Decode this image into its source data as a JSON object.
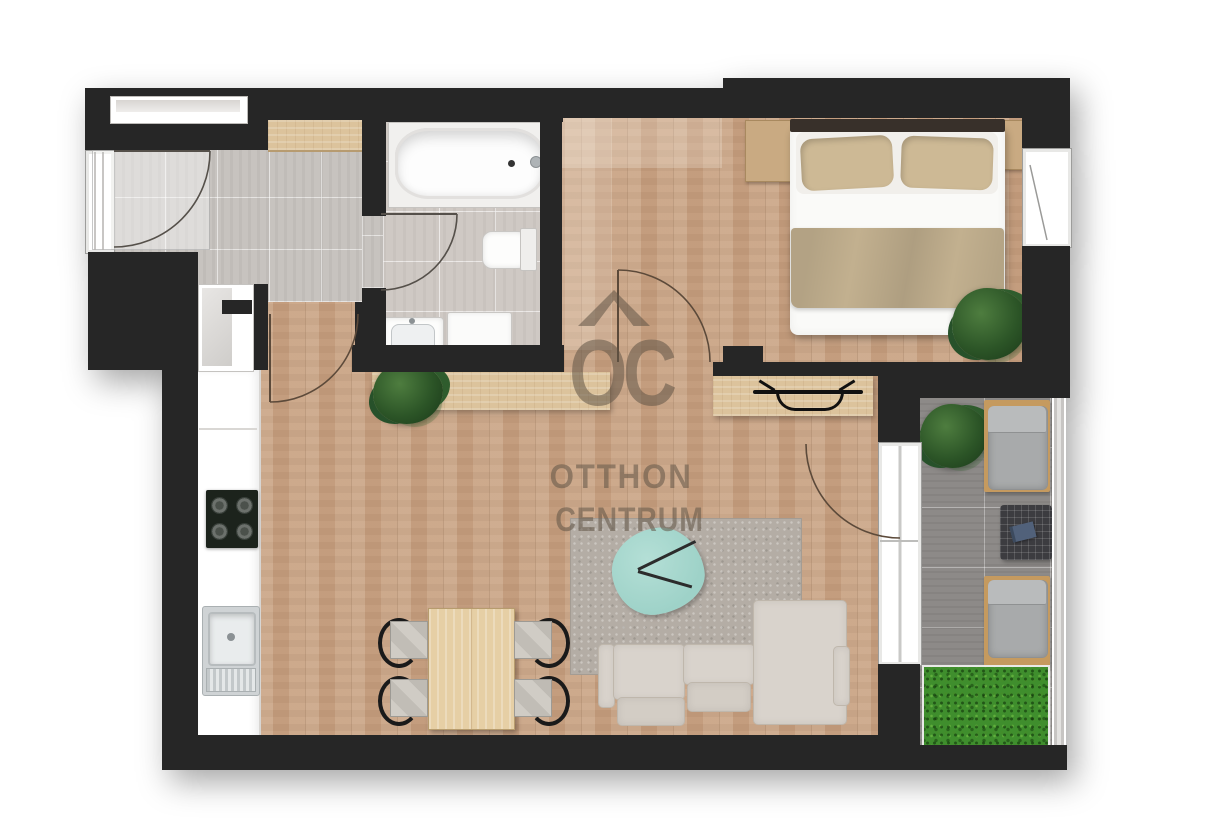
{
  "brand": {
    "logo_text": "OC",
    "chevron_icon": "roof-chevron",
    "line1": "OTTHON",
    "line2": "CENTRUM"
  },
  "palette": {
    "wall": "#262626",
    "wood": "#c8a283",
    "tile_hall": "#c7c3bf",
    "tile_bath": "#cfc9c4",
    "tile_balcony": "#8d8a88",
    "grass": "#3f8e2d",
    "rug": "#b4ada5",
    "coffee_table": "#9ed2c8",
    "sofa": "#d9d3cc",
    "bed_linen": "#fafaf8",
    "bed_blanket": "#c2b08f",
    "pillow": "#cdb995",
    "headboard": "#38302a",
    "counter": "#ffffff",
    "cooktop": "#1c231c",
    "plant": "#2c5527",
    "dining_wood": "#e6cfa5",
    "nightstand": "#c9aa82",
    "console_wood": "#dcc39c",
    "lounger_cushion": "#a8aaab",
    "lounger_wood": "#c59a5f",
    "outdoor_table": "#3c3c40",
    "railing": "#c7c5c3",
    "door_line": "#55504a",
    "background": "#ffffff"
  },
  "rooms": [
    {
      "id": "entrance-hall"
    },
    {
      "id": "bathroom"
    },
    {
      "id": "bedroom"
    },
    {
      "id": "living-room-with-kitchen"
    },
    {
      "id": "balcony"
    }
  ],
  "elements": [
    "entrance-door",
    "hall-closet",
    "bathroom-door",
    "bathtub",
    "toilet",
    "washbasin",
    "washing-machine",
    "double-bed",
    "pillows",
    "nightstand-left",
    "nightstand-right",
    "bedroom-plant",
    "bedroom-window",
    "kitchen-counter",
    "cooktop",
    "kitchen-sink",
    "dining-table",
    "dining-chairs",
    "sofa",
    "chaise",
    "coffee-table",
    "rug",
    "tv-console",
    "tv",
    "plant-shelf",
    "shelf-plant",
    "balcony-sliding-door",
    "balcony-plant",
    "sun-lounger-top",
    "sun-lounger-bottom",
    "outdoor-table",
    "book",
    "grass-patch",
    "railing"
  ]
}
